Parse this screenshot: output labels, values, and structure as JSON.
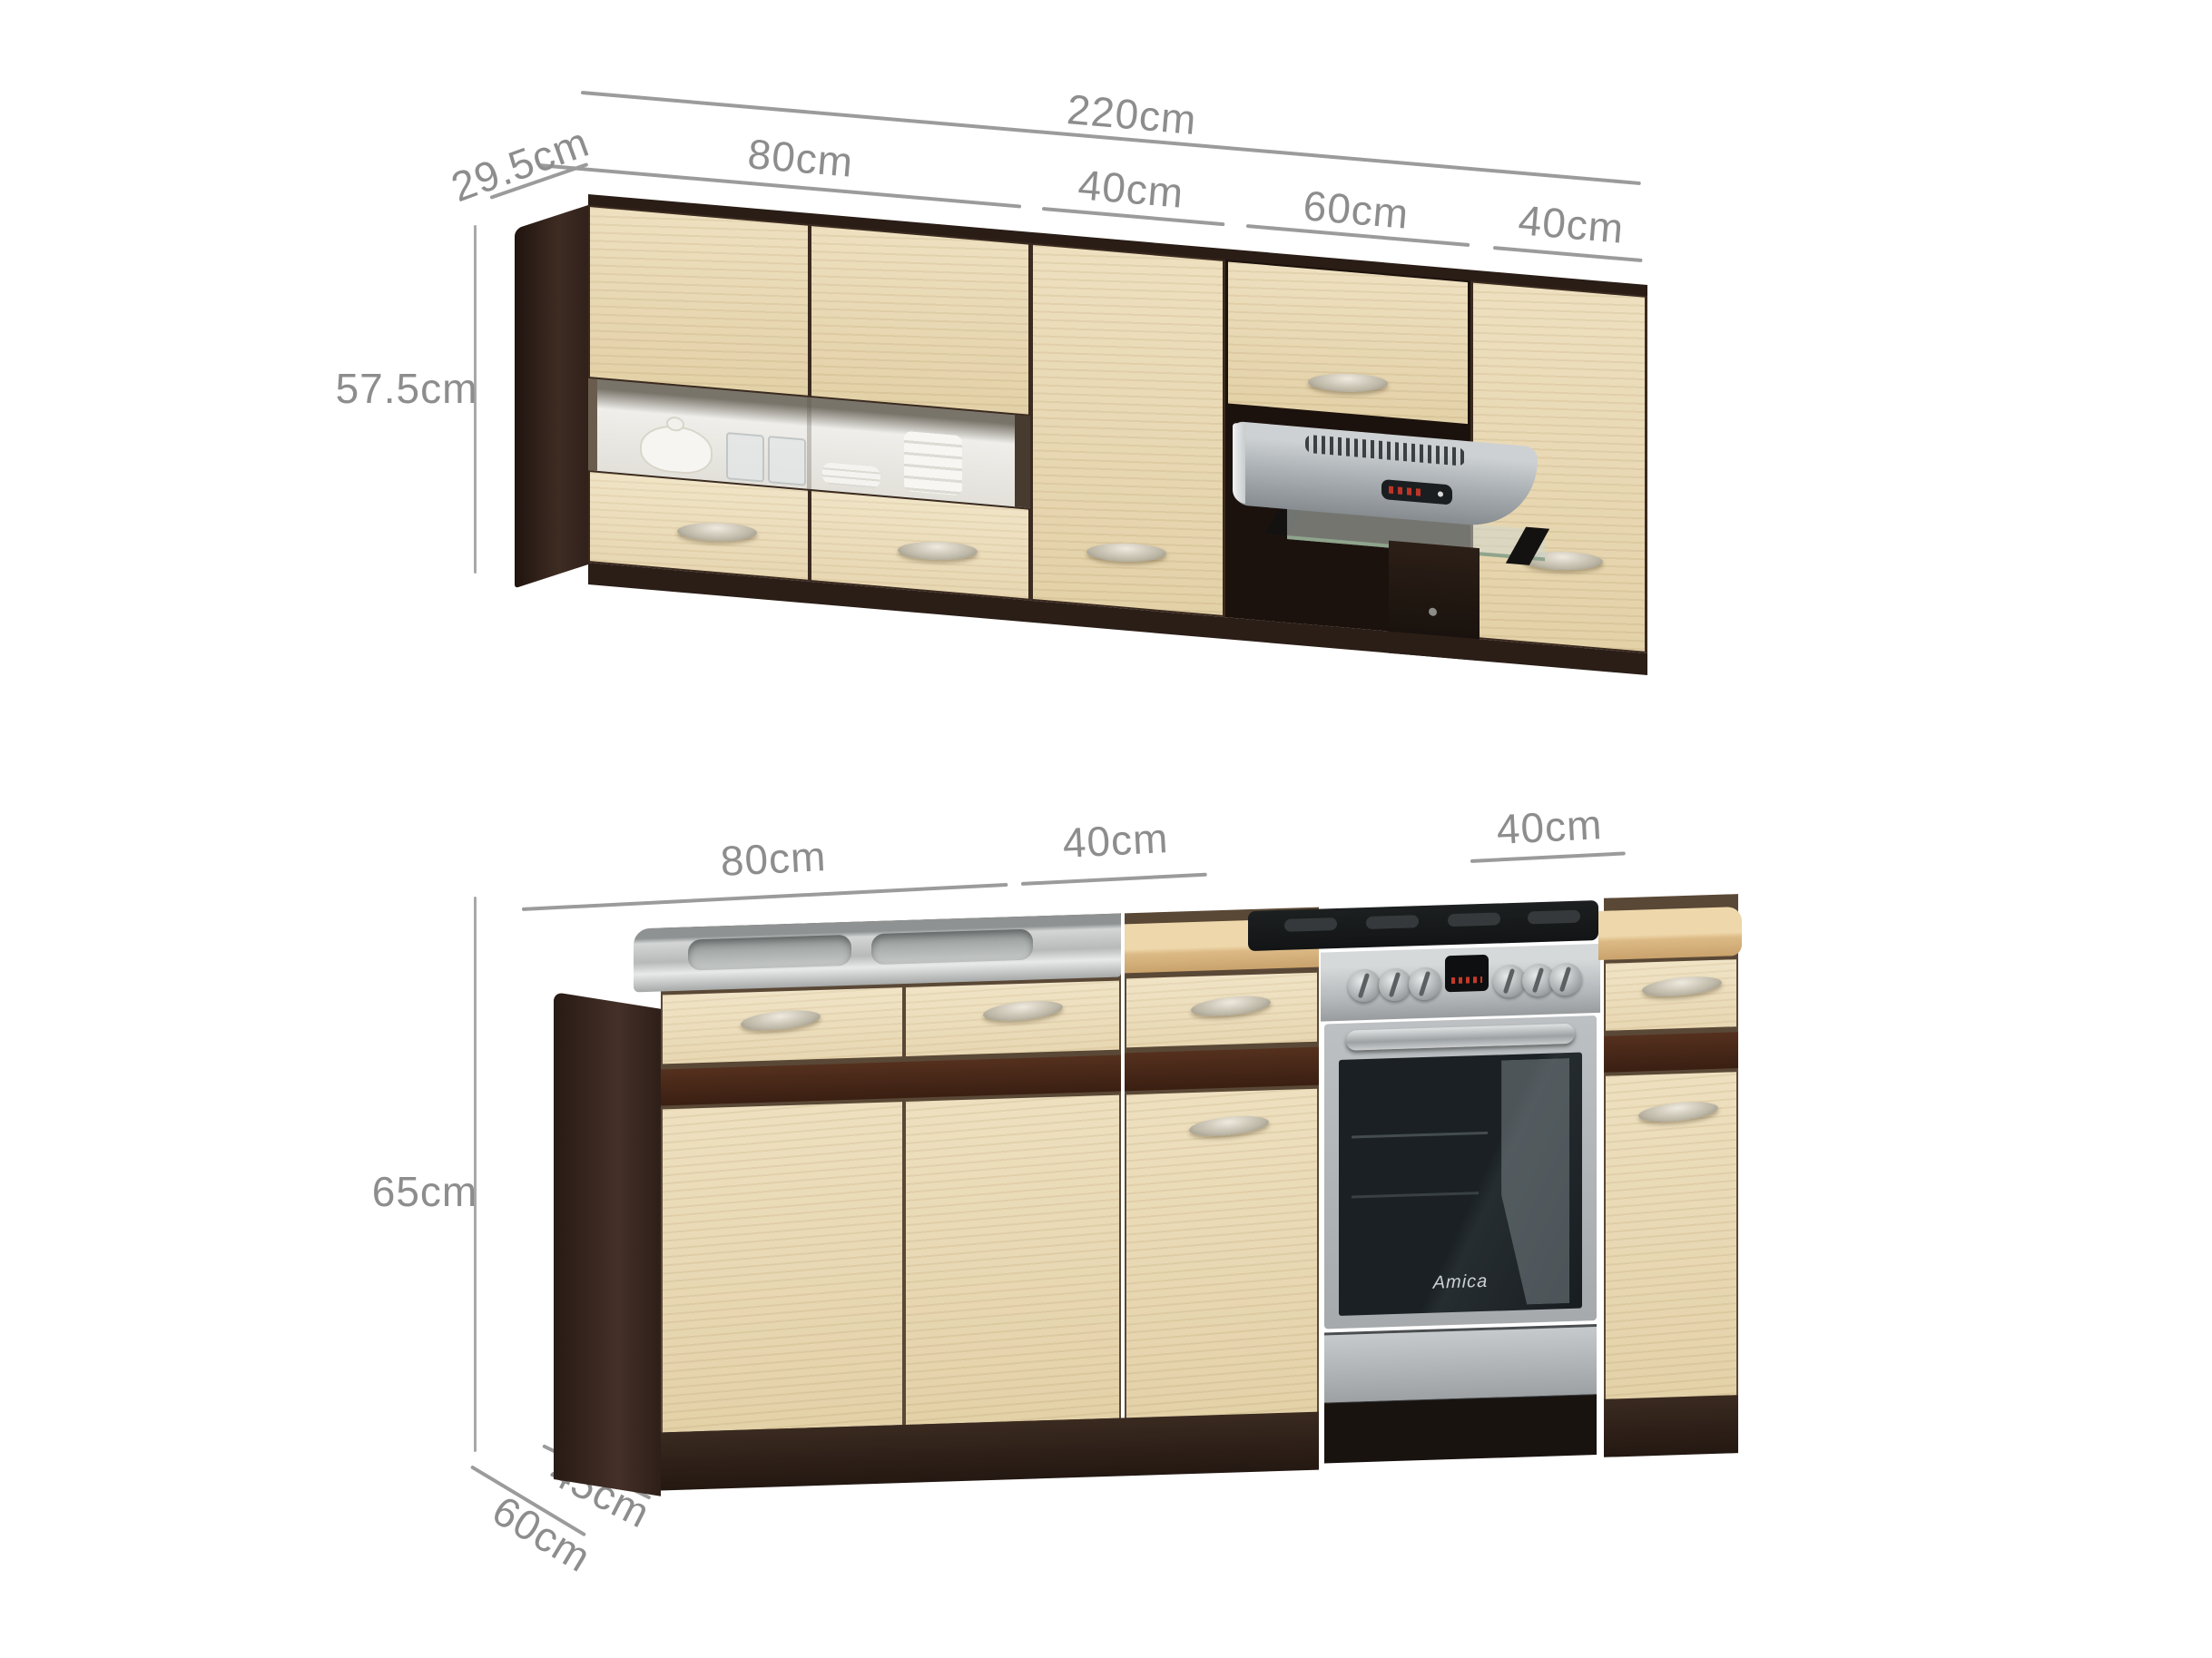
{
  "title": "Kitchen cabinet set dimension diagram",
  "upper_dimensions": {
    "total": {
      "label": "220cm"
    },
    "depth": {
      "label": "29.5cm"
    },
    "height": {
      "label": "57.5cm"
    },
    "segments": [
      {
        "label": "80cm"
      },
      {
        "label": "40cm"
      },
      {
        "label": "60cm"
      },
      {
        "label": "40cm"
      }
    ]
  },
  "lower_dimensions": {
    "height": {
      "label": "65cm"
    },
    "base_depth": {
      "label": "45cm"
    },
    "worktop_depth": {
      "label": "60cm"
    },
    "segments": [
      {
        "label": "80cm"
      },
      {
        "label": "40cm"
      },
      {
        "label": "40cm"
      }
    ]
  },
  "appliances": {
    "oven_brand": "Amica"
  },
  "colors": {
    "background": "#ffffff",
    "dimension_line": "#9b9b9b",
    "dimension_text": "#8d8d8d",
    "cabinet_front_beige": "#e8d8b2",
    "carcass_wenge": "#31221a",
    "accent_stripe": "#4a2718",
    "worktop_beige": "#e7cfa1",
    "stainless_steel": "#bcc0c1"
  }
}
